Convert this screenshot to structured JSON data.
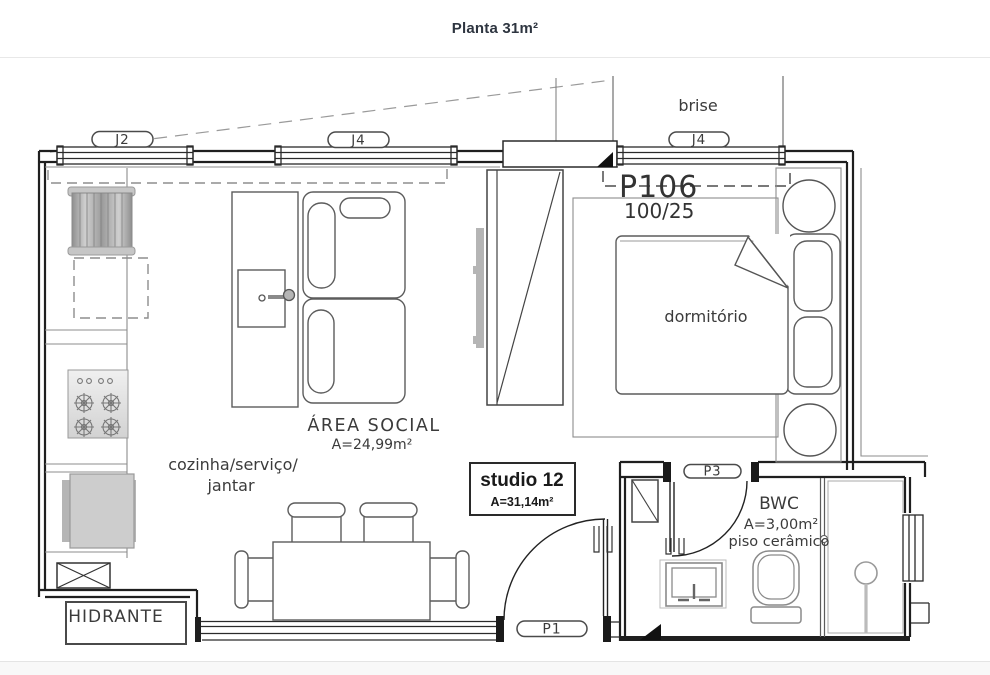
{
  "page": {
    "title": "Planta 31m²"
  },
  "plan": {
    "unit": {
      "code": "P106",
      "size": "100/25"
    },
    "window_labels": [
      "J2",
      "J4",
      "J4"
    ],
    "door_labels": [
      "P3",
      "P1"
    ],
    "labels": {
      "brise": "brise",
      "dormitorio": "dormitório",
      "hidrante": "HIDRANTE"
    },
    "area_social": {
      "name": "ÁREA SOCIAL",
      "area": "A=24,99m²"
    },
    "kitchen": {
      "line1": "cozinha/serviço/",
      "line2": "jantar"
    },
    "studio": {
      "name": "studio 12",
      "area": "A=31,14m²"
    },
    "bwc": {
      "name": "BWC",
      "area": "A=3,00m²",
      "floor": "piso cerâmico"
    },
    "colors": {
      "wall": "#1f1f1f",
      "furniture": "#5c5c5c",
      "appliance": "#c8c8c8",
      "dash": "#8d8d8d"
    }
  }
}
